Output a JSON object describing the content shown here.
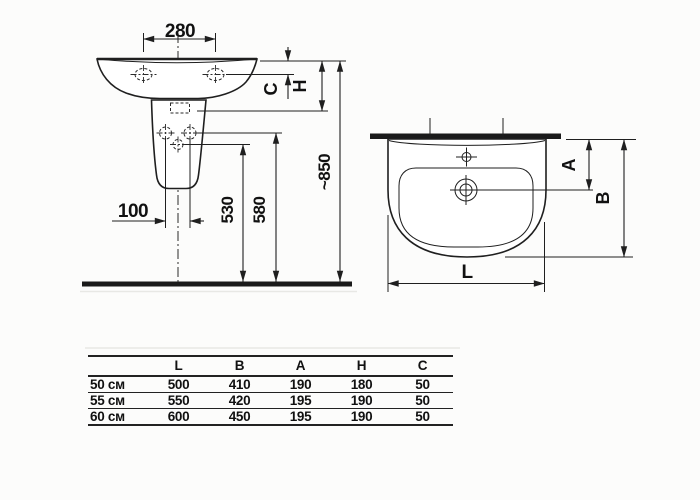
{
  "side_view": {
    "dim_width_top": "280",
    "dim_holes": "100",
    "dim_drain_height": "530",
    "dim_fix_height": "580",
    "dim_total_height": "~850",
    "label_c": "C",
    "label_h": "H"
  },
  "top_view": {
    "label_a": "A",
    "label_b": "B",
    "label_l": "L"
  },
  "table": {
    "headers": [
      "",
      "L",
      "B",
      "A",
      "H",
      "C"
    ],
    "rows": [
      {
        "label": "50 см",
        "values": [
          "500",
          "410",
          "190",
          "180",
          "50"
        ]
      },
      {
        "label": "55 см",
        "values": [
          "550",
          "420",
          "195",
          "190",
          "50"
        ]
      },
      {
        "label": "60 см",
        "values": [
          "600",
          "450",
          "195",
          "190",
          "50"
        ]
      }
    ]
  },
  "colors": {
    "line": "#1f1f1f",
    "background": "#fcfcfb"
  }
}
